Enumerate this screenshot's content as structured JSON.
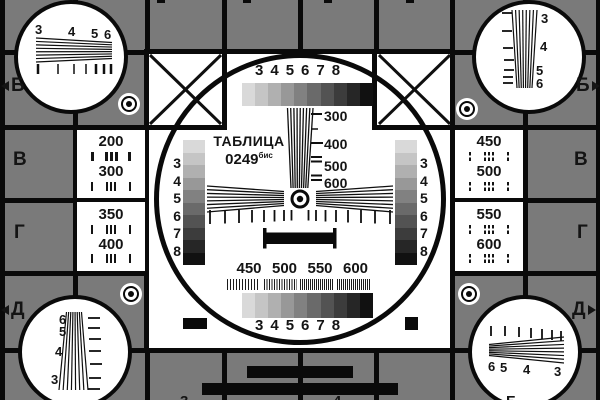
{
  "title": {
    "line1": "ТАБЛИЦА",
    "number": "0249",
    "suffix": "бис"
  },
  "colors": {
    "background": "#7a7a7a",
    "grid": "#0a0a0a",
    "panel_white": "#ffffff",
    "text": "#141414",
    "grayscale_steps": [
      "#d9d9d9",
      "#c5c5c5",
      "#b0b0b0",
      "#989898",
      "#818181",
      "#6a6a6a",
      "#535353",
      "#3c3c3c",
      "#262626",
      "#111111"
    ]
  },
  "edge_markers": {
    "left": [
      "Б",
      "В",
      "Г",
      "Д"
    ],
    "right": [
      "Б",
      "В",
      "Г",
      "Д"
    ]
  },
  "scales": {
    "top_numbers": [
      "3",
      "4",
      "5",
      "6",
      "7",
      "8"
    ],
    "bottom_numbers": [
      "3",
      "4",
      "5",
      "6",
      "7",
      "8"
    ],
    "left_numbers": [
      "3",
      "4",
      "5",
      "6",
      "7",
      "8"
    ],
    "right_numbers": [
      "3",
      "4",
      "5",
      "6",
      "7",
      "8"
    ]
  },
  "center": {
    "vertical_wedge_labels": [
      "300",
      "400",
      "500",
      "600"
    ],
    "horizontal_wedge_labels": [
      "450",
      "500",
      "550",
      "600"
    ]
  },
  "side_panels": {
    "left_numbers": [
      "200",
      "300",
      "350",
      "400"
    ],
    "right_numbers": [
      "450",
      "500",
      "550",
      "600"
    ]
  },
  "corner_circles": {
    "top_left_numbers": [
      "3",
      "4",
      "5",
      "6"
    ],
    "top_right_numbers": [
      "3",
      "4",
      "5",
      "6"
    ],
    "bottom_left_numbers": [
      "6",
      "5",
      "4",
      "3"
    ],
    "bottom_right_numbers": [
      "6",
      "5",
      "4",
      "3"
    ]
  },
  "bottom_edge_partials": [
    "3",
    "4",
    "Б"
  ]
}
